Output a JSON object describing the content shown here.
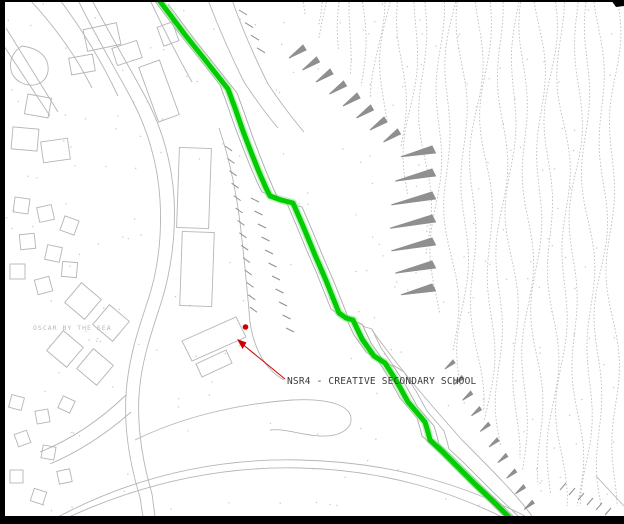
{
  "map": {
    "background_color": "#ffffff",
    "frame_color": "#000000",
    "linework_color": "#b5b5b5",
    "hatch_color": "#8f8f8f",
    "labels": {
      "site": "NSR4 - CREATIVE SECONDARY SCHOOL",
      "estate": "OSCAR BY THE SEA"
    },
    "route_highlight": {
      "color": "#00cc00",
      "width": 5,
      "points": "159,0 171,16 186,36 202,56 217,75 228,89 235,108 243,131 251,152 259,172 266,188 270,196 281,200 293,203 303,226 315,255 325,278 333,298 339,313 346,318 353,320 362,339 374,356 385,363 397,382 408,402 420,416 425,422 428,432 430,440 443,452 458,467 476,485 495,503 511,519 516,524"
    },
    "marker": {
      "color": "#cc0000",
      "dot_x": 245.5,
      "dot_y": 327,
      "arrow_tip_x": 238,
      "arrow_tip_y": 340,
      "leader_from_x": 285,
      "leader_from_y": 379
    }
  }
}
